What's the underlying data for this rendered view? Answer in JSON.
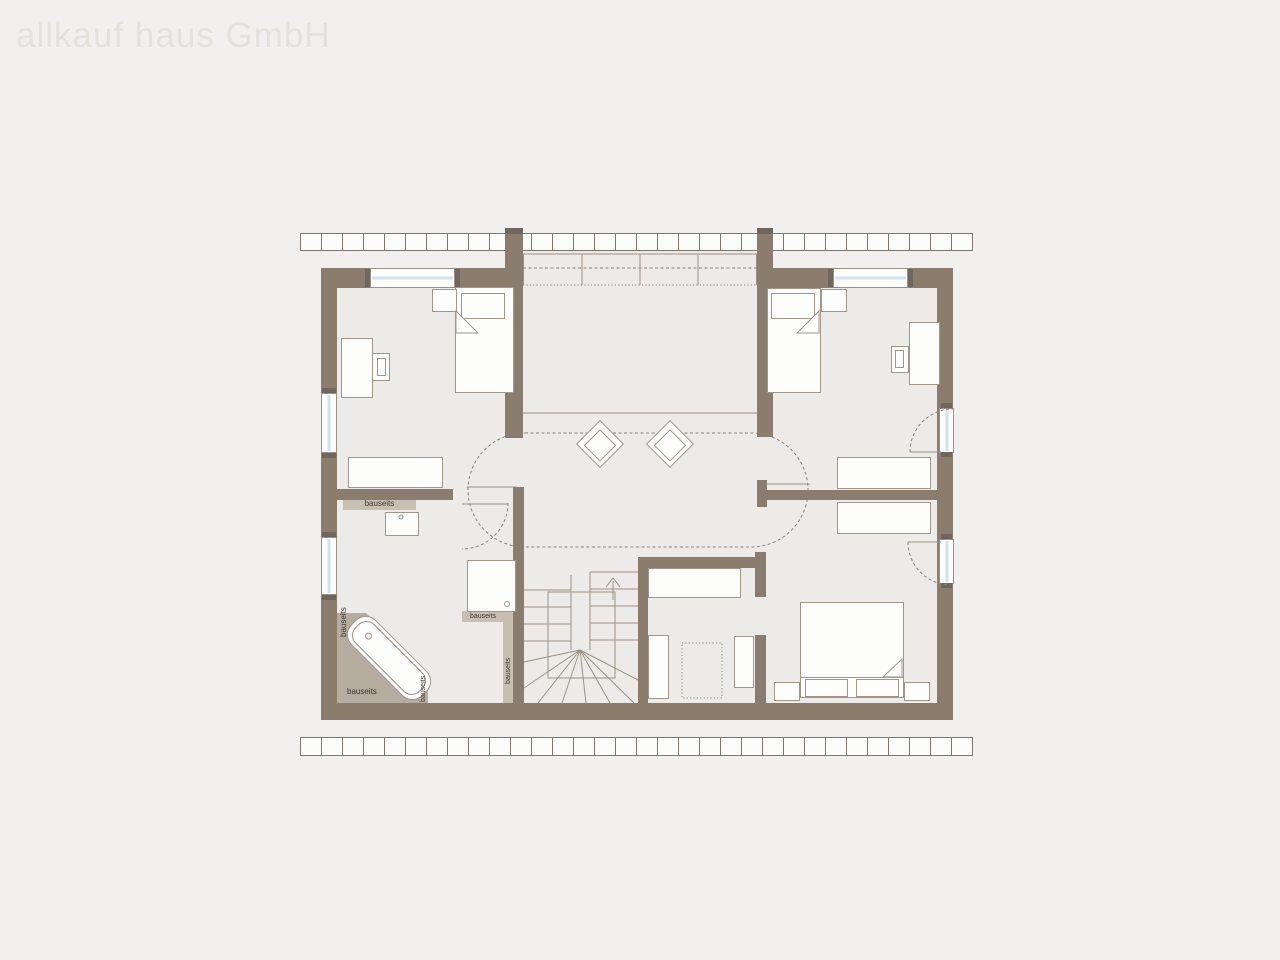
{
  "watermark": {
    "text": "allkauf haus GmbH"
  },
  "labels": {
    "bauseits": "bauseits"
  },
  "stairs": {
    "direction": "up"
  },
  "colors": {
    "background": "#f2f0ee",
    "floor": "#edebe7",
    "wall": "#8a7d6e",
    "wall_dark": "#6f675d",
    "hatch_fill": "#fbfbfa",
    "hatch_line": "#7e766c",
    "furniture_fill": "#fdfdfc",
    "furniture_border": "#a0968a",
    "line": "#9a9184",
    "dash_line": "#8a8074",
    "glass": "#cfe2ee",
    "platform": "#b5ab9f",
    "strip": "#c8bfb3",
    "label_text": "#3f3a35",
    "watermark": "#e5e2dd"
  }
}
